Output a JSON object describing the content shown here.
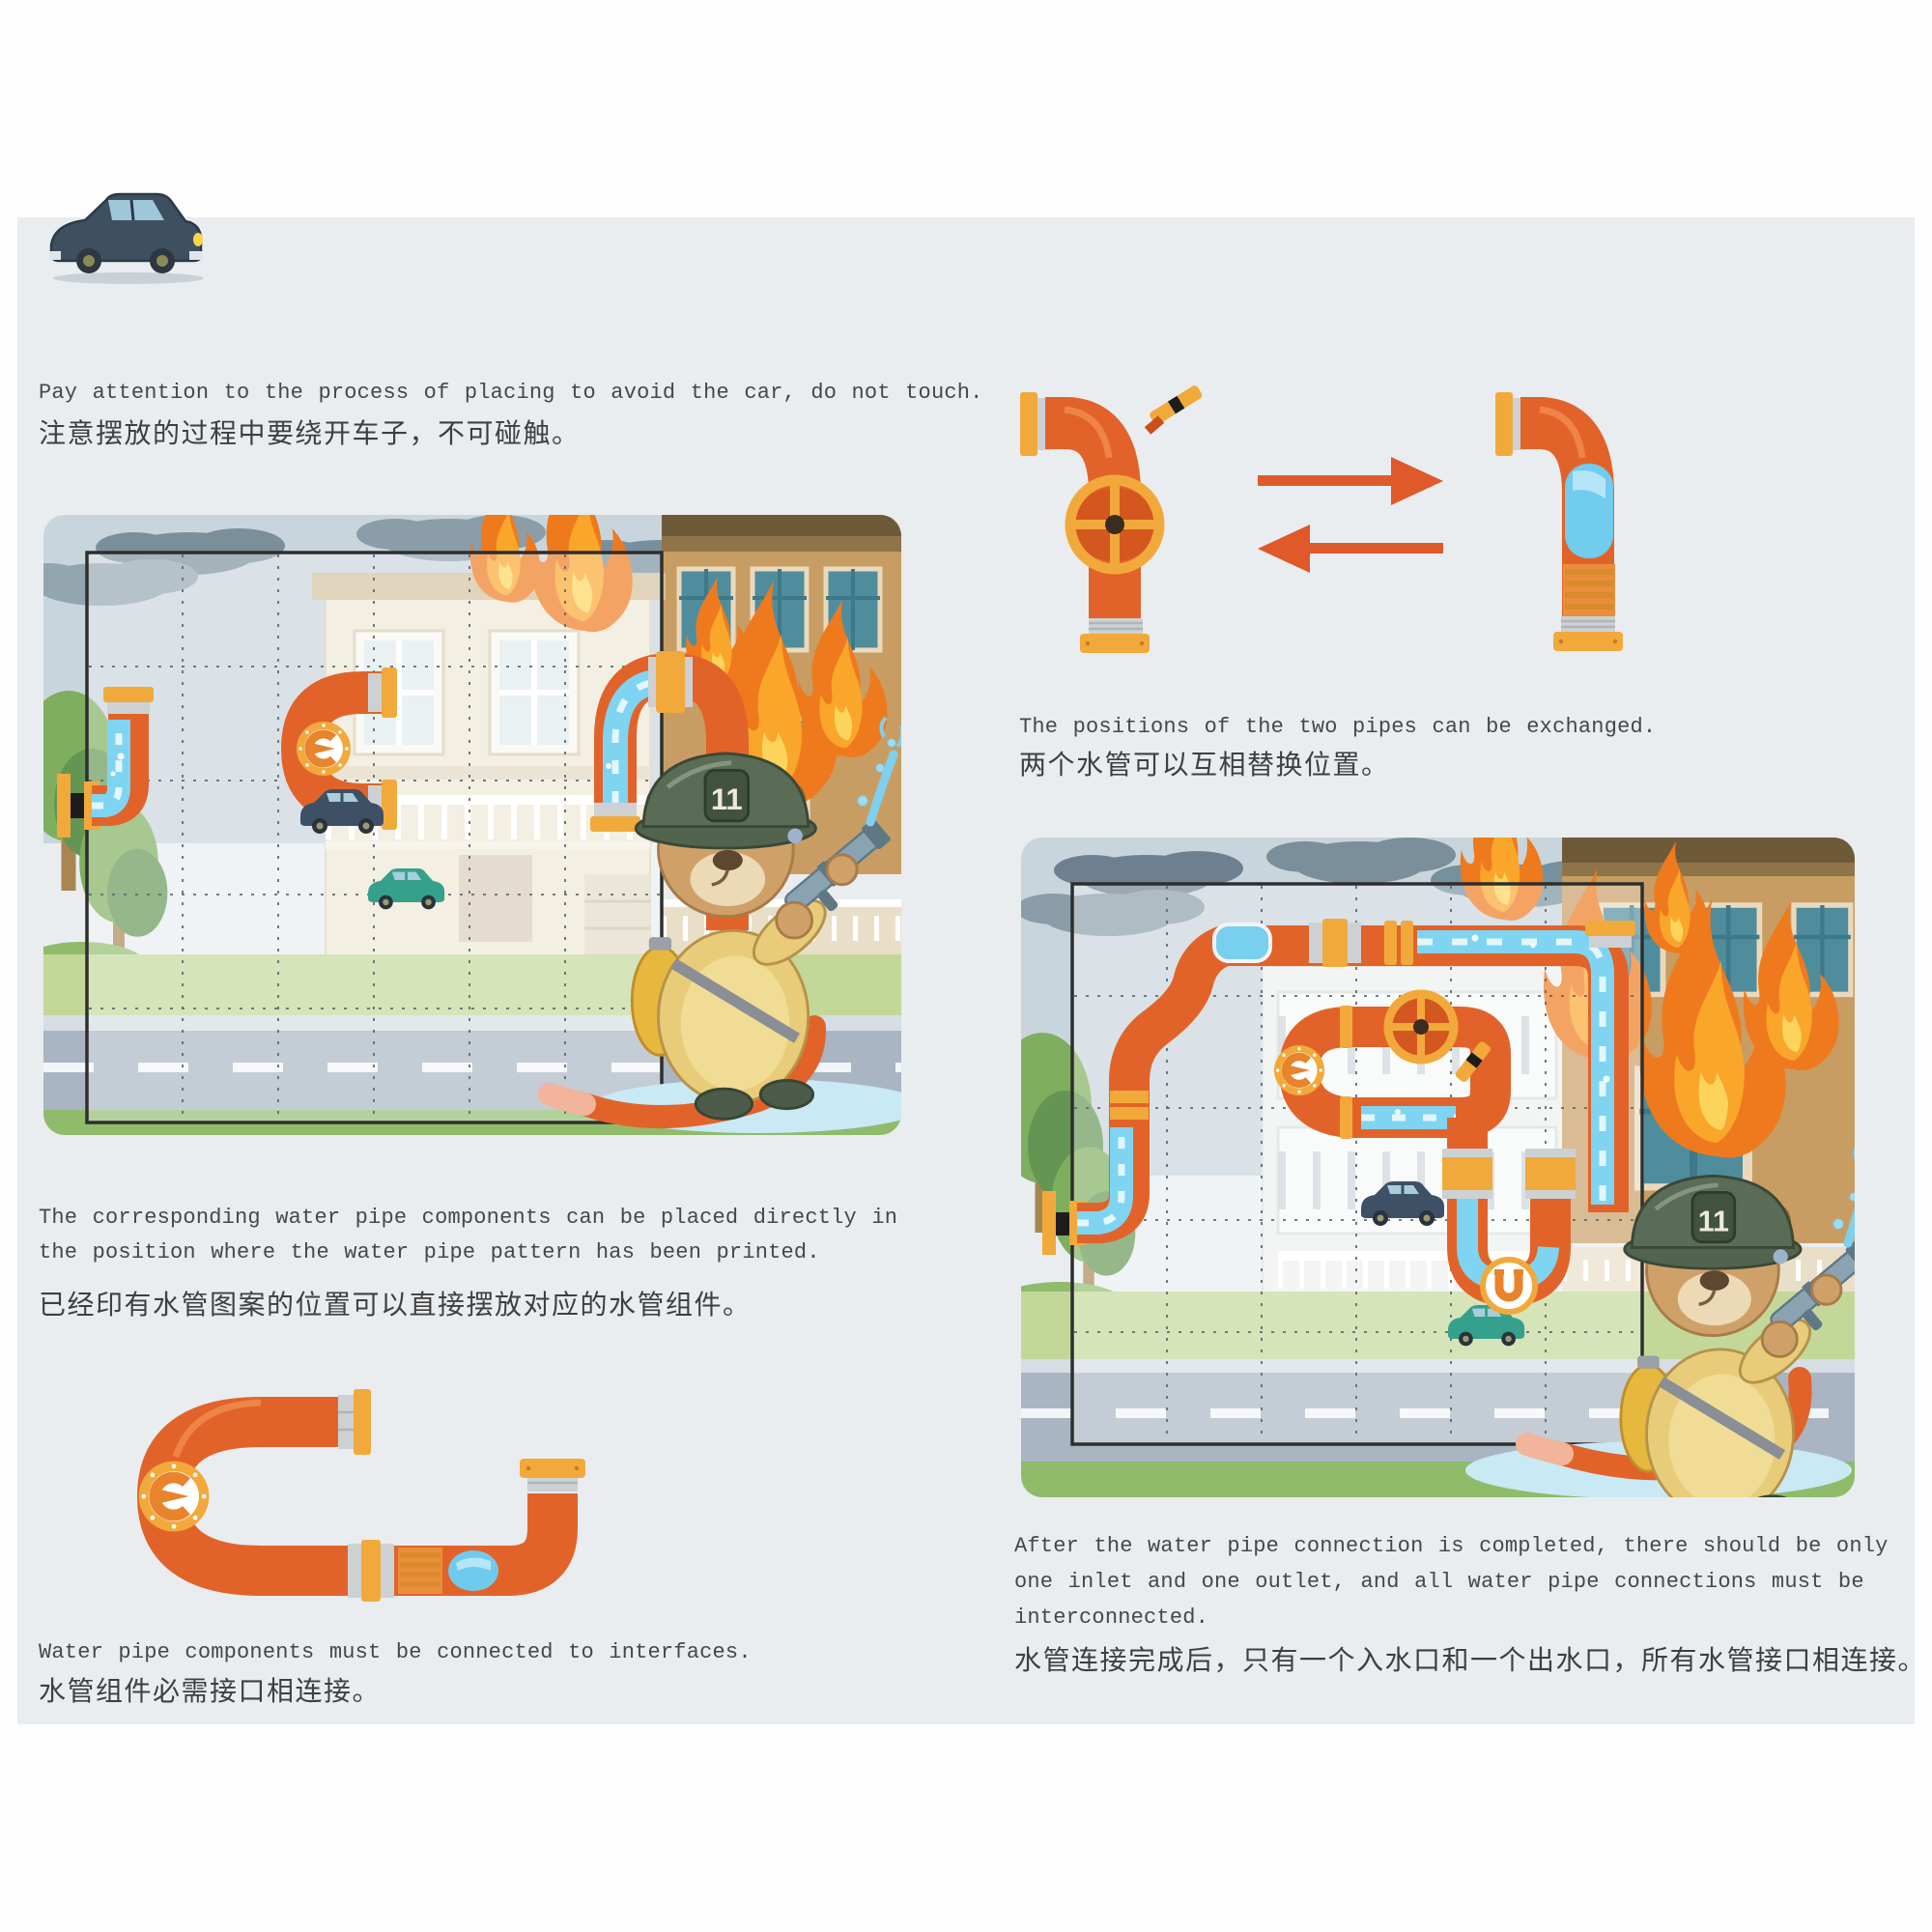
{
  "document": {
    "kind": "water-pipe puzzle game instruction page",
    "languages": "English / Chinese"
  },
  "sections": {
    "car_note": {
      "en": "Pay attention to the process of placing to avoid the car, do not touch.",
      "zh": "注意摆放的过程中要绕开车子，不可碰触。"
    },
    "exchange": {
      "en": "The positions of the two pipes can be exchanged.",
      "zh": "两个水管可以互相替换位置。"
    },
    "printed_pattern": {
      "en1": "The corresponding water pipe components can be placed directly in",
      "en2": "the position where the water pipe pattern has been printed.",
      "zh": "已经印有水管图案的位置可以直接摆放对应的水管组件。"
    },
    "interfaces_note": {
      "en": "Water pipe components must be connected to interfaces.",
      "zh": "水管组件必需接口相连接。"
    },
    "completion": {
      "en1": "After the water pipe connection is completed, there should be only",
      "en2": "one inlet and one outlet, and all water pipe connections must be",
      "en3": "interconnected.",
      "zh": "水管连接完成后，只有一个入水口和一个出水口，所有水管接口相连接。"
    }
  },
  "boards": {
    "grid_columns": 6,
    "grid_rows": 5,
    "helmet_number": "11",
    "pipe_markers": "E, U"
  },
  "illustrations": {
    "car": "dark blue car",
    "board_left": "board with printed pipe patterns and firefighter bear",
    "board_right": "board with completed pipe circuit and firefighter bear",
    "pipe_pair": "valve pipe and window pipe with exchange arrows",
    "pipe_component": "curved pipe component with gauge and water window"
  },
  "colors": {
    "pipe_orange": "#e2632a",
    "flange_yellow": "#f2a93b",
    "water_blue": "#7fd4f2",
    "arrow_red": "#e0592a",
    "panel_bg": "#e9edf0",
    "text": "#474747"
  }
}
